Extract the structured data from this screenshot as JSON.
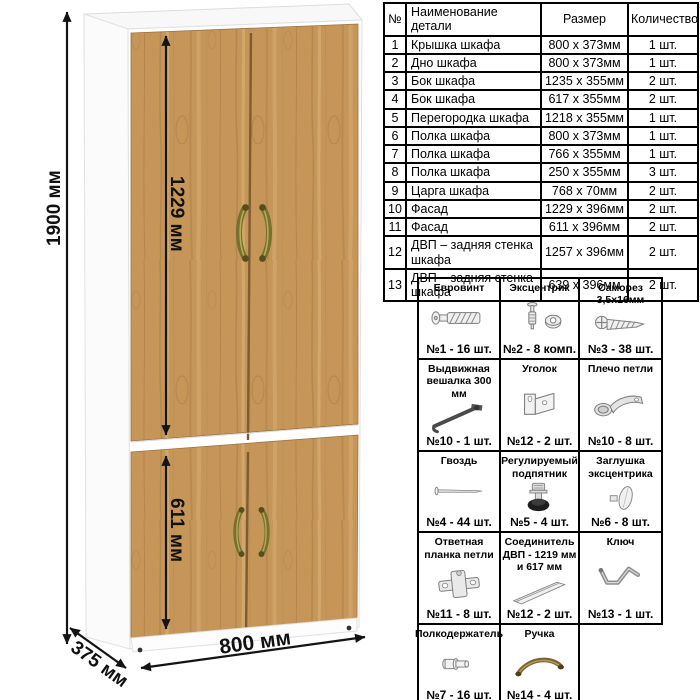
{
  "diagram": {
    "dim_height": "1900 мм",
    "dim_upper_door": "1229 мм",
    "dim_lower_door": "611 мм",
    "dim_width": "800 мм",
    "dim_depth": "375 мм",
    "wood_color": "#c69659",
    "handle_color": "#77702e"
  },
  "parts_table": {
    "headers": [
      "№",
      "Наименование детали",
      "Размер",
      "Количество"
    ],
    "rows": [
      {
        "num": "1",
        "name": "Крышка шкафа",
        "size": "800 x 373мм",
        "qty": "1 шт."
      },
      {
        "num": "2",
        "name": "Дно шкафа",
        "size": "800 x 373мм",
        "qty": "1 шт."
      },
      {
        "num": "3",
        "name": "Бок шкафа",
        "size": "1235 x 355мм",
        "qty": "2 шт."
      },
      {
        "num": "4",
        "name": "Бок шкафа",
        "size": "617 x 355мм",
        "qty": "2 шт."
      },
      {
        "num": "5",
        "name": "Перегородка шкафа",
        "size": "1218 x 355мм",
        "qty": "1 шт."
      },
      {
        "num": "6",
        "name": "Полка шкафа",
        "size": "800 x 373мм",
        "qty": "1 шт."
      },
      {
        "num": "7",
        "name": "Полка шкафа",
        "size": "766 x 355мм",
        "qty": "1 шт."
      },
      {
        "num": "8",
        "name": "Полка шкафа",
        "size": "250 x 355мм",
        "qty": "3 шт."
      },
      {
        "num": "9",
        "name": "Царга шкафа",
        "size": "768 x 70мм",
        "qty": "2 шт."
      },
      {
        "num": "10",
        "name": "Фасад",
        "size": "1229 x 396мм",
        "qty": "2 шт."
      },
      {
        "num": "11",
        "name": "Фасад",
        "size": "611 x 396мм",
        "qty": "2 шт."
      },
      {
        "num": "12",
        "name": "ДВП – задняя стенка шкафа",
        "size": "1257 x 396мм",
        "qty": "2 шт."
      },
      {
        "num": "13",
        "name": "ДВП – задняя стенка шкафа",
        "size": "639 x 396мм",
        "qty": "2 шт."
      }
    ]
  },
  "hardware_grid": {
    "items": [
      {
        "title": "Евровинт",
        "icon": "confirmat-screw-icon",
        "count": "№1 - 16 шт."
      },
      {
        "title": "Эксцентрик",
        "icon": "cam-lock-icon",
        "count": "№2 - 8 комп."
      },
      {
        "title": "Саморез 3,5x16мм",
        "icon": "screw-icon",
        "count": "№3 - 38 шт."
      },
      {
        "title": "Выдвижная вешалка 300 мм",
        "icon": "pullout-hanger-icon",
        "count": "№10 - 1 шт."
      },
      {
        "title": "Уголок",
        "icon": "corner-bracket-icon",
        "count": "№12 - 2 шт."
      },
      {
        "title": "Плечо петли",
        "icon": "hinge-arm-icon",
        "count": "№10 - 8 шт."
      },
      {
        "title": "Гвоздь",
        "icon": "nail-icon",
        "count": "№4 - 44 шт."
      },
      {
        "title": "Регулируемый подпятник",
        "icon": "adjustable-foot-icon",
        "count": "№5 - 4 шт."
      },
      {
        "title": "Заглушка эксцентрика",
        "icon": "cam-cap-icon",
        "count": "№6 - 8 шт."
      },
      {
        "title": "Ответная планка петли",
        "icon": "hinge-plate-icon",
        "count": "№11 - 8 шт."
      },
      {
        "title": "Соединитель ДВП - 1219 мм и 617 мм",
        "icon": "hdf-connector-icon",
        "count": "№12 - 2 шт."
      },
      {
        "title": "Ключ",
        "icon": "hex-key-icon",
        "count": "№13 - 1 шт."
      },
      {
        "title": "Полкодержатель",
        "icon": "shelf-pin-icon",
        "count": "№7 - 16 шт."
      },
      {
        "title": "Ручка",
        "icon": "handle-icon",
        "count": "№14 - 4 шт."
      }
    ]
  }
}
